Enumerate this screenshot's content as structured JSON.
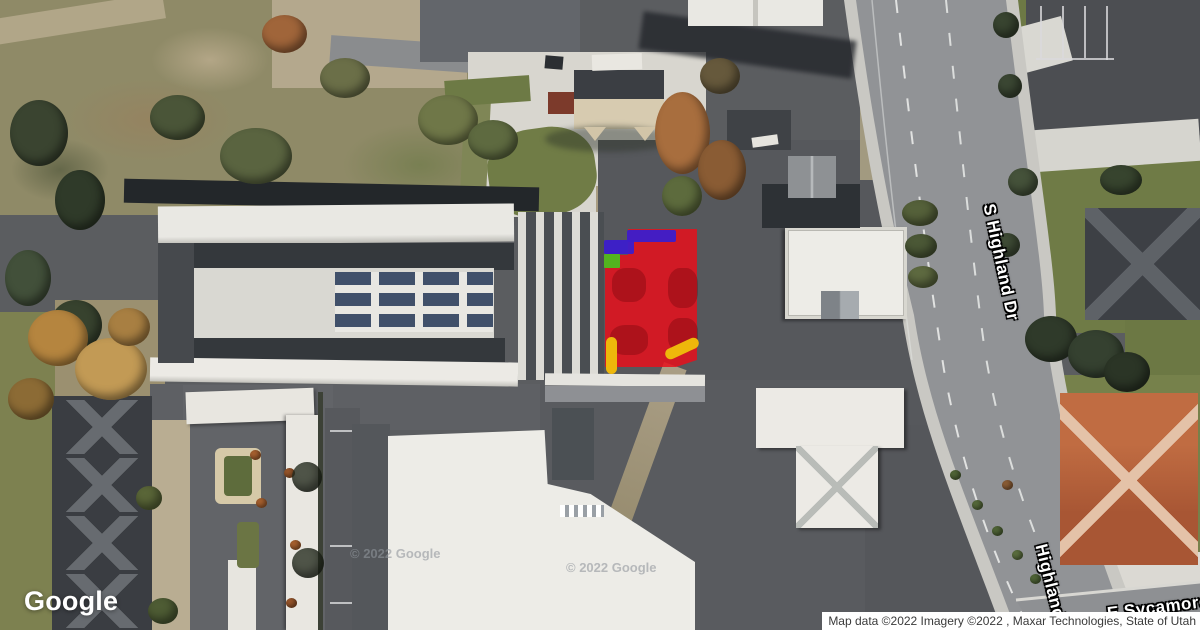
{
  "branding": {
    "logo_text": "Google"
  },
  "attribution": {
    "text": "Map data ©2022 Imagery ©2022 , Maxar Technologies, State of Utah"
  },
  "watermark": {
    "text": "© 2022 Google"
  },
  "streets": {
    "highland_dr": {
      "label": "S Highland Dr"
    },
    "highland": {
      "label": "Highland"
    },
    "sycamore": {
      "label": "E Sycamore L"
    }
  },
  "overlays": {
    "parcel_red": {
      "label": "highlighted parcel",
      "color": "#e80e1a"
    },
    "marker_blue": {
      "label": "blue edge marker",
      "color": "#3c1ecb"
    },
    "marker_green": {
      "label": "green corner marker",
      "color": "#53b41f"
    },
    "marker_yellow": {
      "label": "yellow access marks",
      "color": "#eeb70b"
    }
  }
}
